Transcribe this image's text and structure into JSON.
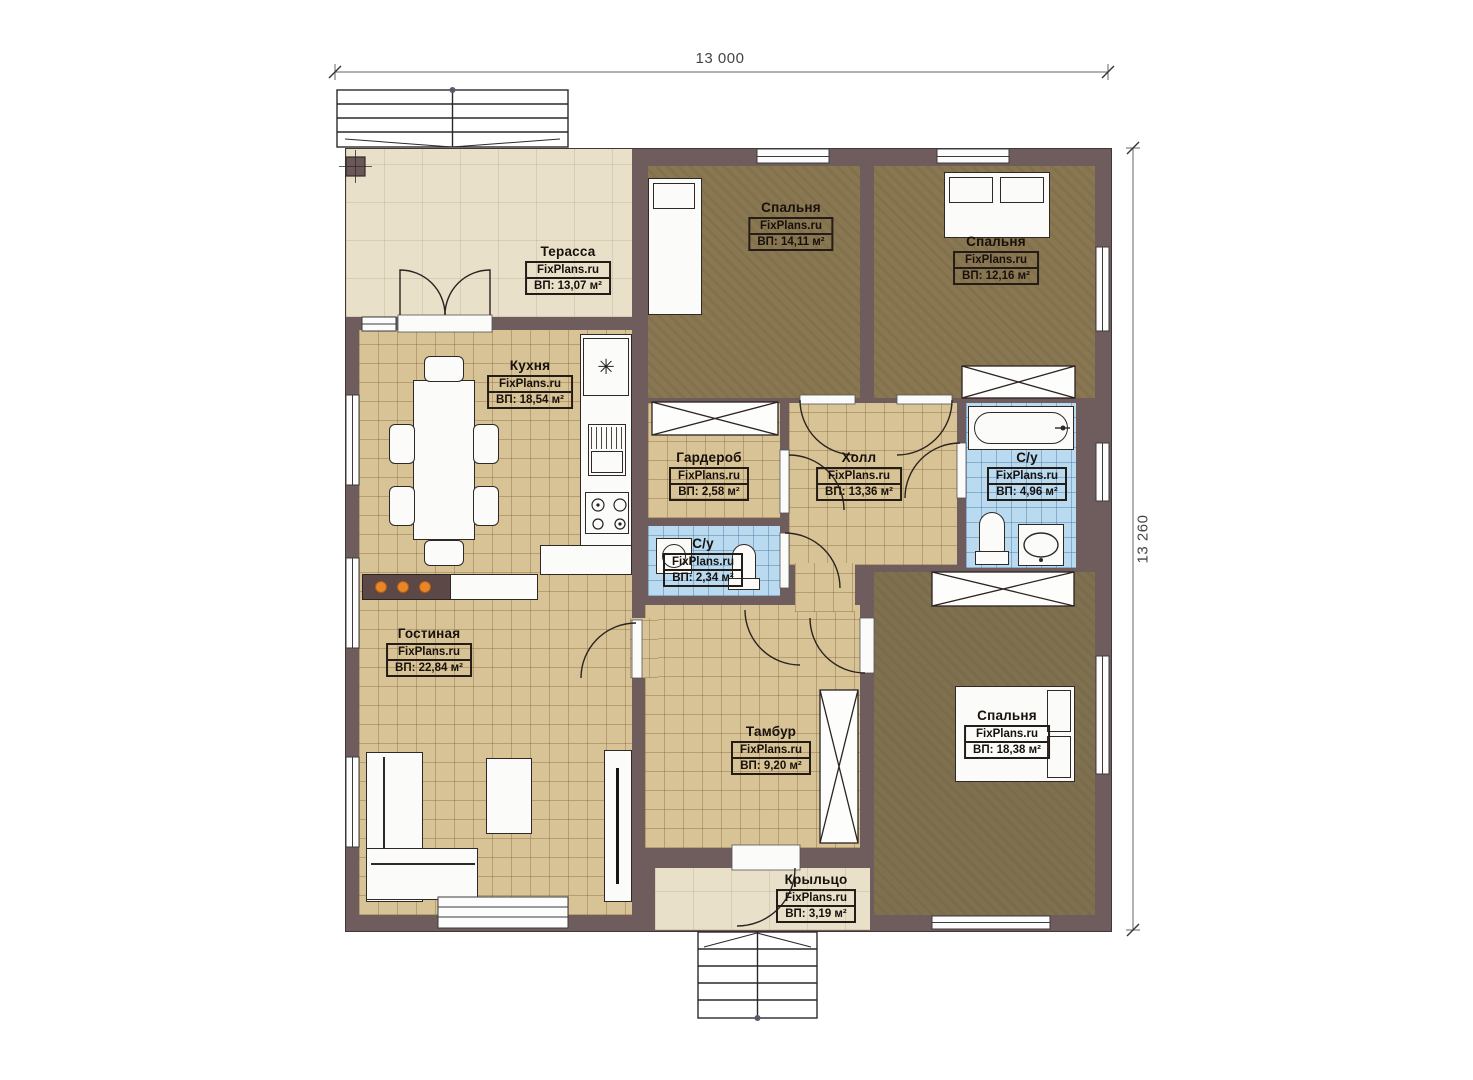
{
  "dimensions": {
    "width": "13 000",
    "height": "13 260"
  },
  "rooms": [
    {
      "name": "Терасса",
      "brand": "FixPlans.ru",
      "area": "ВП: 13,07 м²"
    },
    {
      "name": "Спальня",
      "brand": "FixPlans.ru",
      "area": "ВП: 14,11 м²"
    },
    {
      "name": "Спальня",
      "brand": "FixPlans.ru",
      "area": "ВП: 12,16 м²"
    },
    {
      "name": "Кухня",
      "brand": "FixPlans.ru",
      "area": "ВП: 18,54 м²"
    },
    {
      "name": "Гардероб",
      "brand": "FixPlans.ru",
      "area": "ВП: 2,58 м²"
    },
    {
      "name": "Холл",
      "brand": "FixPlans.ru",
      "area": "ВП: 13,36 м²"
    },
    {
      "name": "С/у",
      "brand": "FixPlans.ru",
      "area": "ВП: 4,96 м²"
    },
    {
      "name": "С/у",
      "brand": "FixPlans.ru",
      "area": "ВП: 2,34 м²"
    },
    {
      "name": "Гостиная",
      "brand": "FixPlans.ru",
      "area": "ВП: 22,84 м²"
    },
    {
      "name": "Тамбур",
      "brand": "FixPlans.ru",
      "area": "ВП: 9,20 м²"
    },
    {
      "name": "Спальня",
      "brand": "FixPlans.ru",
      "area": "ВП: 18,38 м²"
    },
    {
      "name": "Крыльцо",
      "brand": "FixPlans.ru",
      "area": "ВП: 3,19 м²"
    }
  ],
  "icons": {
    "fridge": "✳"
  },
  "colors": {
    "wall": "#6f5c5c",
    "tile_tan": "#d8c396",
    "tile_blue": "#badaf0",
    "carpet_brown": "#897752",
    "terrace_beige": "#e9e0ca",
    "fireplace_dot": "#e8862a"
  }
}
